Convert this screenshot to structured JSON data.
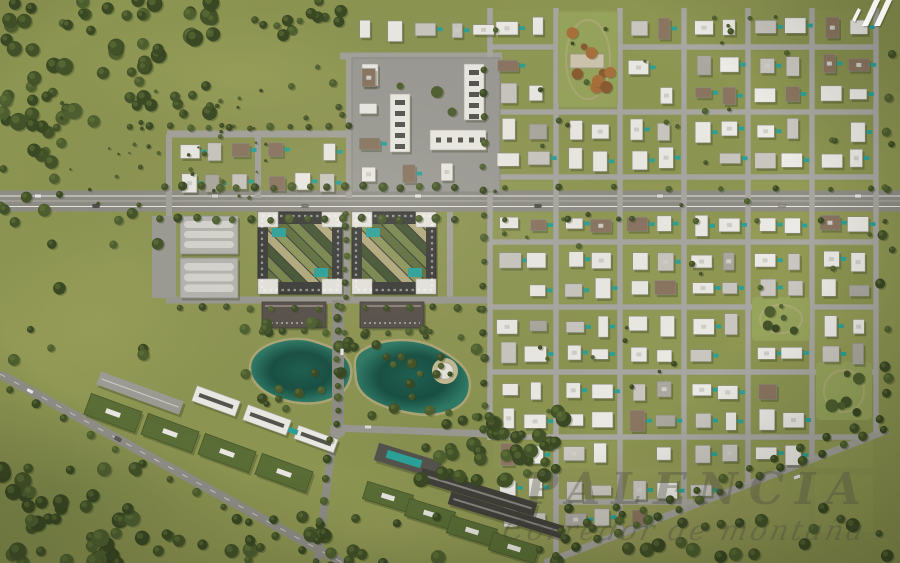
{
  "title": "Master-planned community aerial render",
  "watermark": {
    "line1": "PALENCIA",
    "line2": "Corredor de montaña"
  },
  "logo": {
    "label": "developer-logo-mark",
    "color": "#ffffff"
  },
  "palette": {
    "grass": "#8d9552",
    "grass_light": "#a4ac61",
    "grass_dark": "#6d7a41",
    "forest": [
      "#435228",
      "#4e5f2f",
      "#3a4823"
    ],
    "forest_highlight": "#6d7f3f",
    "autumn": [
      "#a8703c",
      "#c08a4e",
      "#8a5c30"
    ],
    "road": "#8e8d86",
    "road_minor": "#a3a29b",
    "road_grid": "#a8a7a1",
    "dash": "#e9e7e0",
    "building_white": "#eceae4",
    "building_gray": "#c9c7bf",
    "building_brown": "#8a7560",
    "building_mid": "#aaa89f",
    "block_dark": "#3b3b39",
    "roof_green": "#5a6d36",
    "slab_dark": "#413f3a",
    "plaza": "#9b9a94",
    "warehouse": "#b6b5af",
    "warehouse_stripe": "#d6d5cf",
    "brown_building": "#57504a",
    "pool": "#2aa198",
    "lake_deep": "#174f42",
    "lake_mid": "#1d5f4f",
    "lake_edge": "#2e7a66",
    "shore": "#b3a97c",
    "sand": "#c4bb90",
    "deck_white": "#e8e5dc",
    "shadow": "#39421f"
  },
  "scene": {
    "width": 900,
    "height": 563,
    "diag": {
      "m": -0.391,
      "b": 776
    },
    "patches": [
      {
        "cx": 240,
        "cy": 75,
        "rx": 170,
        "ry": 65,
        "t": "l",
        "o": 0.45
      },
      {
        "cx": 95,
        "cy": 330,
        "rx": 150,
        "ry": 85,
        "t": "l",
        "o": 0.4
      },
      {
        "cx": 690,
        "cy": 250,
        "rx": 210,
        "ry": 150,
        "t": "l",
        "o": 0.2
      },
      {
        "cx": 640,
        "cy": 505,
        "rx": 210,
        "ry": 60,
        "t": "t",
        "o": 0.35
      },
      {
        "cx": 60,
        "cy": 490,
        "rx": 190,
        "ry": 95,
        "t": "d",
        "o": 0.4
      },
      {
        "cx": 850,
        "cy": 60,
        "rx": 130,
        "ry": 90,
        "t": "d",
        "o": 0.2
      },
      {
        "cx": 470,
        "cy": 455,
        "rx": 150,
        "ry": 65,
        "t": "d",
        "o": 0.3
      },
      {
        "cx": 380,
        "cy": 525,
        "rx": 130,
        "ry": 45,
        "t": "l",
        "o": 0.25
      },
      {
        "cx": 120,
        "cy": 265,
        "rx": 120,
        "ry": 70,
        "t": "l",
        "o": 0.25
      }
    ],
    "lakes": {
      "paths": [
        "M252,362 C258,344 292,336 312,342 C332,348 352,356 350,374 C348,393 328,404 302,402 C274,400 246,384 252,362 Z",
        "M362,352 C382,338 418,338 438,350 C458,361 472,372 468,391 C464,410 437,417 411,412 C384,407 358,398 357,377 C356,366 354,358 362,352 Z"
      ],
      "island": {
        "cx": 445,
        "cy": 371,
        "r_sand": 13,
        "r_deck": 8.5
      }
    },
    "roads": [
      {
        "x1": 0,
        "y1": 201,
        "x2": 900,
        "y2": 201,
        "w": 21,
        "c": "#8e8d86"
      },
      {
        "x1": 0,
        "y1": 201,
        "x2": 900,
        "y2": 201,
        "w": 1.6,
        "c": "#a6a49b"
      },
      {
        "x1": 0,
        "y1": 196,
        "x2": 900,
        "y2": 196,
        "w": 0.9,
        "c": "#e9e7e0",
        "dash": true
      },
      {
        "x1": 0,
        "y1": 206.5,
        "x2": 900,
        "y2": 206.5,
        "w": 0.9,
        "c": "#e9e7e0",
        "dash": true
      },
      {
        "x1": 167,
        "y1": 134,
        "x2": 490,
        "y2": 134,
        "w": 7,
        "c": "#a3a29b"
      },
      {
        "x1": 169,
        "y1": 134,
        "x2": 169,
        "y2": 302,
        "w": 6,
        "c": "#a3a29b"
      },
      {
        "x1": 258,
        "y1": 134,
        "x2": 258,
        "y2": 198,
        "w": 6,
        "c": "#a3a29b"
      },
      {
        "x1": 349,
        "y1": 56,
        "x2": 349,
        "y2": 198,
        "w": 6,
        "c": "#a3a29b"
      },
      {
        "x1": 340,
        "y1": 56,
        "x2": 502,
        "y2": 56,
        "w": 7,
        "c": "#a3a29b"
      },
      {
        "x1": 346,
        "y1": 212,
        "x2": 346,
        "y2": 300,
        "w": 8,
        "c": "#98978f"
      },
      {
        "x1": 450,
        "y1": 212,
        "x2": 450,
        "y2": 300,
        "w": 6,
        "c": "#a3a29b"
      },
      {
        "x1": 166,
        "y1": 300,
        "x2": 492,
        "y2": 300,
        "w": 7,
        "c": "#9a9991"
      },
      {
        "x1": 338,
        "y1": 300,
        "x2": 338,
        "y2": 428,
        "w": 12,
        "c": "#8e8d86"
      },
      {
        "x1": 338,
        "y1": 428,
        "x2": 492,
        "y2": 434,
        "w": 7,
        "c": "#9a9991"
      },
      {
        "x1": 334,
        "y1": 430,
        "x2": 317,
        "y2": 563,
        "w": 8,
        "c": "#8f8e87"
      },
      {
        "x1": 0,
        "y1": 374,
        "x2": 343,
        "y2": 563,
        "w": 9,
        "c": "#8f8e87",
        "dash": true
      },
      {
        "x1": 545,
        "y1": 563,
        "x2": 888,
        "y2": 430,
        "w": 7,
        "c": "#a3a29b"
      },
      {
        "x1": 490,
        "y1": 8,
        "x2": 490,
        "y2": 440,
        "w": 5.5,
        "c": "#a8a7a1"
      },
      {
        "x1": 556,
        "y1": 8,
        "x2": 556,
        "y2": 555,
        "w": 5.5,
        "c": "#a8a7a1"
      },
      {
        "x1": 620,
        "y1": 8,
        "x2": 620,
        "y2": 533,
        "w": 5.5,
        "c": "#a8a7a1"
      },
      {
        "x1": 684,
        "y1": 8,
        "x2": 684,
        "y2": 508,
        "w": 5.5,
        "c": "#a8a7a1"
      },
      {
        "x1": 748,
        "y1": 8,
        "x2": 748,
        "y2": 484,
        "w": 5.5,
        "c": "#a8a7a1"
      },
      {
        "x1": 812,
        "y1": 8,
        "x2": 812,
        "y2": 459,
        "w": 5.5,
        "c": "#a8a7a1"
      },
      {
        "x1": 876,
        "y1": 8,
        "x2": 876,
        "y2": 433,
        "w": 5.5,
        "c": "#a8a7a1"
      },
      {
        "x1": 490,
        "y1": 47,
        "x2": 878,
        "y2": 47,
        "w": 5.5,
        "c": "#a8a7a1"
      },
      {
        "x1": 490,
        "y1": 112,
        "x2": 878,
        "y2": 112,
        "w": 5.5,
        "c": "#a8a7a1"
      },
      {
        "x1": 490,
        "y1": 177,
        "x2": 878,
        "y2": 177,
        "w": 5.5,
        "c": "#a8a7a1"
      },
      {
        "x1": 490,
        "y1": 242,
        "x2": 878,
        "y2": 242,
        "w": 5.5,
        "c": "#a8a7a1"
      },
      {
        "x1": 490,
        "y1": 307,
        "x2": 878,
        "y2": 307,
        "w": 5.5,
        "c": "#a8a7a1"
      },
      {
        "x1": 490,
        "y1": 372,
        "x2": 878,
        "y2": 372,
        "w": 5.5,
        "c": "#a8a7a1"
      },
      {
        "x1": 490,
        "y1": 437,
        "x2": 866,
        "y2": 437,
        "w": 5.5,
        "c": "#a8a7a1"
      },
      {
        "x1": 556,
        "y1": 502,
        "x2": 693,
        "y2": 502,
        "w": 5.5,
        "c": "#a8a7a1"
      }
    ],
    "campus": {
      "plaza": {
        "x": 352,
        "y": 58,
        "w": 148,
        "h": 134
      },
      "slabs": [
        {
          "x": 362,
          "y": 64,
          "w": 16,
          "h": 22,
          "t": "w"
        },
        {
          "x": 390,
          "y": 94,
          "w": 20,
          "h": 58,
          "t": "v"
        },
        {
          "x": 464,
          "y": 64,
          "w": 20,
          "h": 56,
          "t": "v"
        },
        {
          "x": 430,
          "y": 130,
          "w": 56,
          "h": 20,
          "t": "h"
        }
      ],
      "trees": [
        [
          437,
          92,
          6
        ],
        [
          452,
          112,
          4.5
        ],
        [
          400,
          86,
          3.5
        ]
      ]
    },
    "warehouses": [
      {
        "x": 180,
        "y": 216,
        "w": 58,
        "h": 38
      },
      {
        "x": 180,
        "y": 258,
        "w": 58,
        "h": 40
      }
    ],
    "warehouse_parking": {
      "x": 152,
      "y": 216,
      "w": 24,
      "h": 82
    },
    "dark_blocks": [
      {
        "x": 258,
        "y": 212,
        "w": 84,
        "h": 82
      },
      {
        "x": 352,
        "y": 212,
        "w": 84,
        "h": 82
      }
    ],
    "brown_buildings": [
      {
        "x": 262,
        "y": 302,
        "w": 64,
        "h": 26
      },
      {
        "x": 360,
        "y": 302,
        "w": 64,
        "h": 26
      }
    ],
    "zones": [
      {
        "x0": 176,
        "y0": 136,
        "x1": 252,
        "y1": 198,
        "cols": 3,
        "rows": 2,
        "seed": 11,
        "fill": 0.97,
        "pool": 0.7,
        "wW": 0.4,
        "wG": 0.6,
        "wB": 0.95
      },
      {
        "x0": 264,
        "y0": 136,
        "x1": 342,
        "y1": 198,
        "cols": 3,
        "rows": 2,
        "seed": 12,
        "fill": 0.97,
        "pool": 0.7,
        "wW": 0.4,
        "wG": 0.6,
        "wB": 0.95
      },
      {
        "x0": 352,
        "y0": 14,
        "x1": 500,
        "y1": 48,
        "cols": 5,
        "rows": 1,
        "seed": 13,
        "fill": 0.95,
        "pool": 0.4,
        "wW": 0.6,
        "wG": 0.75,
        "wB": 0.95
      },
      {
        "x0": 352,
        "y0": 62,
        "x1": 388,
        "y1": 190,
        "cols": 1,
        "rows": 4,
        "seed": 14,
        "fill": 0.95,
        "pool": 0.6,
        "wW": 0.5,
        "wG": 0.65,
        "wB": 0.95
      },
      {
        "x0": 392,
        "y0": 156,
        "x1": 500,
        "y1": 190,
        "cols": 3,
        "rows": 1,
        "seed": 15,
        "fill": 0.95,
        "pool": 0.6,
        "wW": 0.6,
        "wG": 0.75,
        "wB": 0.95
      }
    ],
    "residential": {
      "xs": [
        490,
        556,
        620,
        684,
        748,
        812,
        876
      ],
      "rows": [
        [
          10,
          44
        ],
        [
          51,
          109
        ],
        [
          116,
          174
        ],
        [
          181,
          239
        ],
        [
          246,
          304
        ],
        [
          311,
          369
        ],
        [
          376,
          434
        ],
        [
          441,
          468
        ],
        [
          475,
          532
        ]
      ],
      "seed": 99,
      "fill": 0.93,
      "pool": 0.55,
      "wW": 0.62,
      "wG": 0.78,
      "wB": 0.93
    },
    "parks": [
      {
        "x": 558,
        "y": 12,
        "w": 60,
        "h": 95,
        "t": "autumn",
        "bld": true,
        "seed": 31,
        "n": 9
      },
      {
        "x": 752,
        "y": 297,
        "w": 58,
        "h": 44,
        "t": "green",
        "seed": 32,
        "n": 5
      },
      {
        "x": 816,
        "y": 362,
        "w": 56,
        "h": 58,
        "t": "green",
        "seed": 33,
        "n": 6
      }
    ],
    "sw_cluster": [
      {
        "cx": 140,
        "cy": 393,
        "w": 88,
        "h": 14,
        "rot": 20,
        "t": "park"
      },
      {
        "cx": 113,
        "cy": 413,
        "w": 54,
        "h": 22,
        "rot": 20,
        "t": "green"
      },
      {
        "cx": 170,
        "cy": 433,
        "w": 54,
        "h": 22,
        "rot": 20,
        "t": "green"
      },
      {
        "cx": 227,
        "cy": 453,
        "w": 54,
        "h": 22,
        "rot": 20,
        "t": "green"
      },
      {
        "cx": 284,
        "cy": 473,
        "w": 54,
        "h": 22,
        "rot": 20,
        "t": "green"
      },
      {
        "cx": 216,
        "cy": 401,
        "w": 46,
        "h": 16,
        "rot": 20,
        "t": "white"
      },
      {
        "cx": 267,
        "cy": 420,
        "w": 46,
        "h": 16,
        "rot": 20,
        "t": "white"
      },
      {
        "cx": 316,
        "cy": 439,
        "w": 42,
        "h": 14,
        "rot": 20,
        "t": "white"
      },
      {
        "cx": 293,
        "cy": 431,
        "w": 10,
        "h": 5,
        "rot": 20,
        "t": "pool"
      }
    ],
    "sc_cluster": [
      {
        "cx": 408,
        "cy": 461,
        "w": 66,
        "h": 18,
        "rot": 17,
        "t": "deck"
      },
      {
        "cx": 404,
        "cy": 459,
        "w": 36,
        "h": 8,
        "rot": 17,
        "t": "pool"
      },
      {
        "cx": 478,
        "cy": 492,
        "w": 120,
        "h": 14,
        "rot": 17,
        "t": "dark"
      },
      {
        "cx": 506,
        "cy": 515,
        "w": 118,
        "h": 13,
        "rot": 17,
        "t": "dark"
      },
      {
        "cx": 388,
        "cy": 497,
        "w": 48,
        "h": 18,
        "rot": 17,
        "t": "green"
      },
      {
        "cx": 430,
        "cy": 514,
        "w": 48,
        "h": 18,
        "rot": 17,
        "t": "green"
      },
      {
        "cx": 472,
        "cy": 531,
        "w": 48,
        "h": 18,
        "rot": 17,
        "t": "green"
      },
      {
        "cx": 514,
        "cy": 548,
        "w": 48,
        "h": 18,
        "rot": 17,
        "t": "green"
      }
    ],
    "tree_clusters": [
      {
        "x": 0,
        "y": 0,
        "w": 220,
        "h": 122,
        "n": 70,
        "rmin": 4,
        "rmax": 9,
        "seed": 1
      },
      {
        "x": 0,
        "y": 122,
        "w": 62,
        "h": 90,
        "n": 16,
        "rmin": 3.5,
        "rmax": 7,
        "seed": 2
      },
      {
        "x": 218,
        "y": 0,
        "w": 140,
        "h": 36,
        "n": 15,
        "rmin": 3,
        "rmax": 6.5,
        "seed": 3
      },
      {
        "x": 60,
        "y": 90,
        "w": 210,
        "h": 115,
        "n": 42,
        "rmin": 1,
        "rmax": 2.6,
        "seed": 4
      },
      {
        "x": 235,
        "y": 322,
        "w": 125,
        "h": 88,
        "n": 20,
        "rmin": 3,
        "rmax": 6,
        "seed": 5
      },
      {
        "x": 362,
        "y": 330,
        "w": 118,
        "h": 92,
        "n": 22,
        "rmin": 3,
        "rmax": 6,
        "seed": 6
      },
      {
        "x": 0,
        "y": 468,
        "w": 165,
        "h": 95,
        "n": 46,
        "rmin": 4,
        "rmax": 9,
        "seed": 7
      },
      {
        "x": 158,
        "y": 514,
        "w": 285,
        "h": 49,
        "n": 30,
        "rmin": 4,
        "rmax": 8,
        "seed": 8
      },
      {
        "x": 420,
        "y": 410,
        "w": 150,
        "h": 74,
        "n": 40,
        "rmin": 4,
        "rmax": 8,
        "seed": 9
      },
      {
        "x": 545,
        "y": 498,
        "w": 350,
        "h": 64,
        "n": 28,
        "rmin": 3.5,
        "rmax": 7.5,
        "seed": 10
      },
      {
        "x": 878,
        "y": 0,
        "w": 22,
        "h": 424,
        "n": 12,
        "rmin": 3,
        "rmax": 5.5,
        "seed": 21
      },
      {
        "x": 494,
        "y": 10,
        "w": 378,
        "h": 420,
        "n": 48,
        "rmin": 1.6,
        "rmax": 3.4,
        "seed": 22
      },
      {
        "x": 0,
        "y": 212,
        "w": 160,
        "h": 150,
        "n": 12,
        "rmin": 3,
        "rmax": 6.5,
        "seed": 23
      },
      {
        "x": 286,
        "y": 60,
        "w": 60,
        "h": 60,
        "n": 6,
        "rmin": 2,
        "rmax": 4,
        "seed": 24
      }
    ],
    "tree_rows": [
      {
        "x1": 165,
        "y1": 187,
        "x2": 455,
        "y2": 187,
        "n": 17,
        "r": 4
      },
      {
        "x1": 160,
        "y1": 219,
        "x2": 455,
        "y2": 219,
        "n": 17,
        "r": 4
      },
      {
        "x1": 505,
        "y1": 188,
        "x2": 885,
        "y2": 188,
        "n": 8,
        "r": 3
      },
      {
        "x1": 505,
        "y1": 220,
        "x2": 885,
        "y2": 220,
        "n": 7,
        "r": 3
      },
      {
        "x1": 338,
        "y1": 306,
        "x2": 338,
        "y2": 424,
        "n": 10,
        "r": 3.6
      },
      {
        "x1": 346,
        "y1": 214,
        "x2": 346,
        "y2": 296,
        "n": 7,
        "r": 3.2
      },
      {
        "x1": 130,
        "y1": 127,
        "x2": 350,
        "y2": 127,
        "n": 12,
        "r": 3.4
      },
      {
        "x1": 180,
        "y1": 308,
        "x2": 480,
        "y2": 308,
        "n": 14,
        "r": 3.4
      },
      {
        "x1": 556,
        "y1": 556,
        "x2": 884,
        "y2": 429,
        "n": 17,
        "r": 4.2
      },
      {
        "x1": 540,
        "y1": 550,
        "x2": 880,
        "y2": 418,
        "n": 14,
        "r": 4.2
      },
      {
        "x1": 10,
        "y1": 390,
        "x2": 330,
        "y2": 566,
        "n": 13,
        "r": 4
      },
      {
        "x1": 484,
        "y1": 70,
        "x2": 484,
        "y2": 430,
        "n": 16,
        "r": 3.6
      },
      {
        "x1": 330,
        "y1": 440,
        "x2": 316,
        "y2": 560,
        "n": 7,
        "r": 3.8
      },
      {
        "x1": 262,
        "y1": 332,
        "x2": 430,
        "y2": 332,
        "n": 9,
        "r": 3.4
      }
    ],
    "cars": [
      {
        "x": 38,
        "y": 196,
        "r": 0,
        "c": "#e9e9e7"
      },
      {
        "x": 96,
        "y": 206,
        "r": 0,
        "c": "#4d4d4b"
      },
      {
        "x": 215,
        "y": 196,
        "r": 0,
        "c": "#d8d8d4"
      },
      {
        "x": 305,
        "y": 206,
        "r": 0,
        "c": "#777670"
      },
      {
        "x": 418,
        "y": 196,
        "r": 0,
        "c": "#e9e9e7"
      },
      {
        "x": 538,
        "y": 206,
        "r": 0,
        "c": "#55544f"
      },
      {
        "x": 660,
        "y": 196,
        "r": 0,
        "c": "#e0e0dc"
      },
      {
        "x": 782,
        "y": 206,
        "r": 0,
        "c": "#99978f"
      },
      {
        "x": 858,
        "y": 196,
        "r": 0,
        "c": "#e9e9e7"
      },
      {
        "x": 30,
        "y": 391,
        "r": 29,
        "c": "#e9e9e7"
      },
      {
        "x": 118,
        "y": 439,
        "r": 29,
        "c": "#5a5a58"
      },
      {
        "x": 368,
        "y": 427,
        "r": 2,
        "c": "#dcdcd8"
      },
      {
        "x": 342,
        "y": 352,
        "r": 90,
        "c": "#e9e9e7"
      },
      {
        "x": 797,
        "y": 477,
        "r": -21,
        "c": "#e9e9e7"
      }
    ]
  }
}
